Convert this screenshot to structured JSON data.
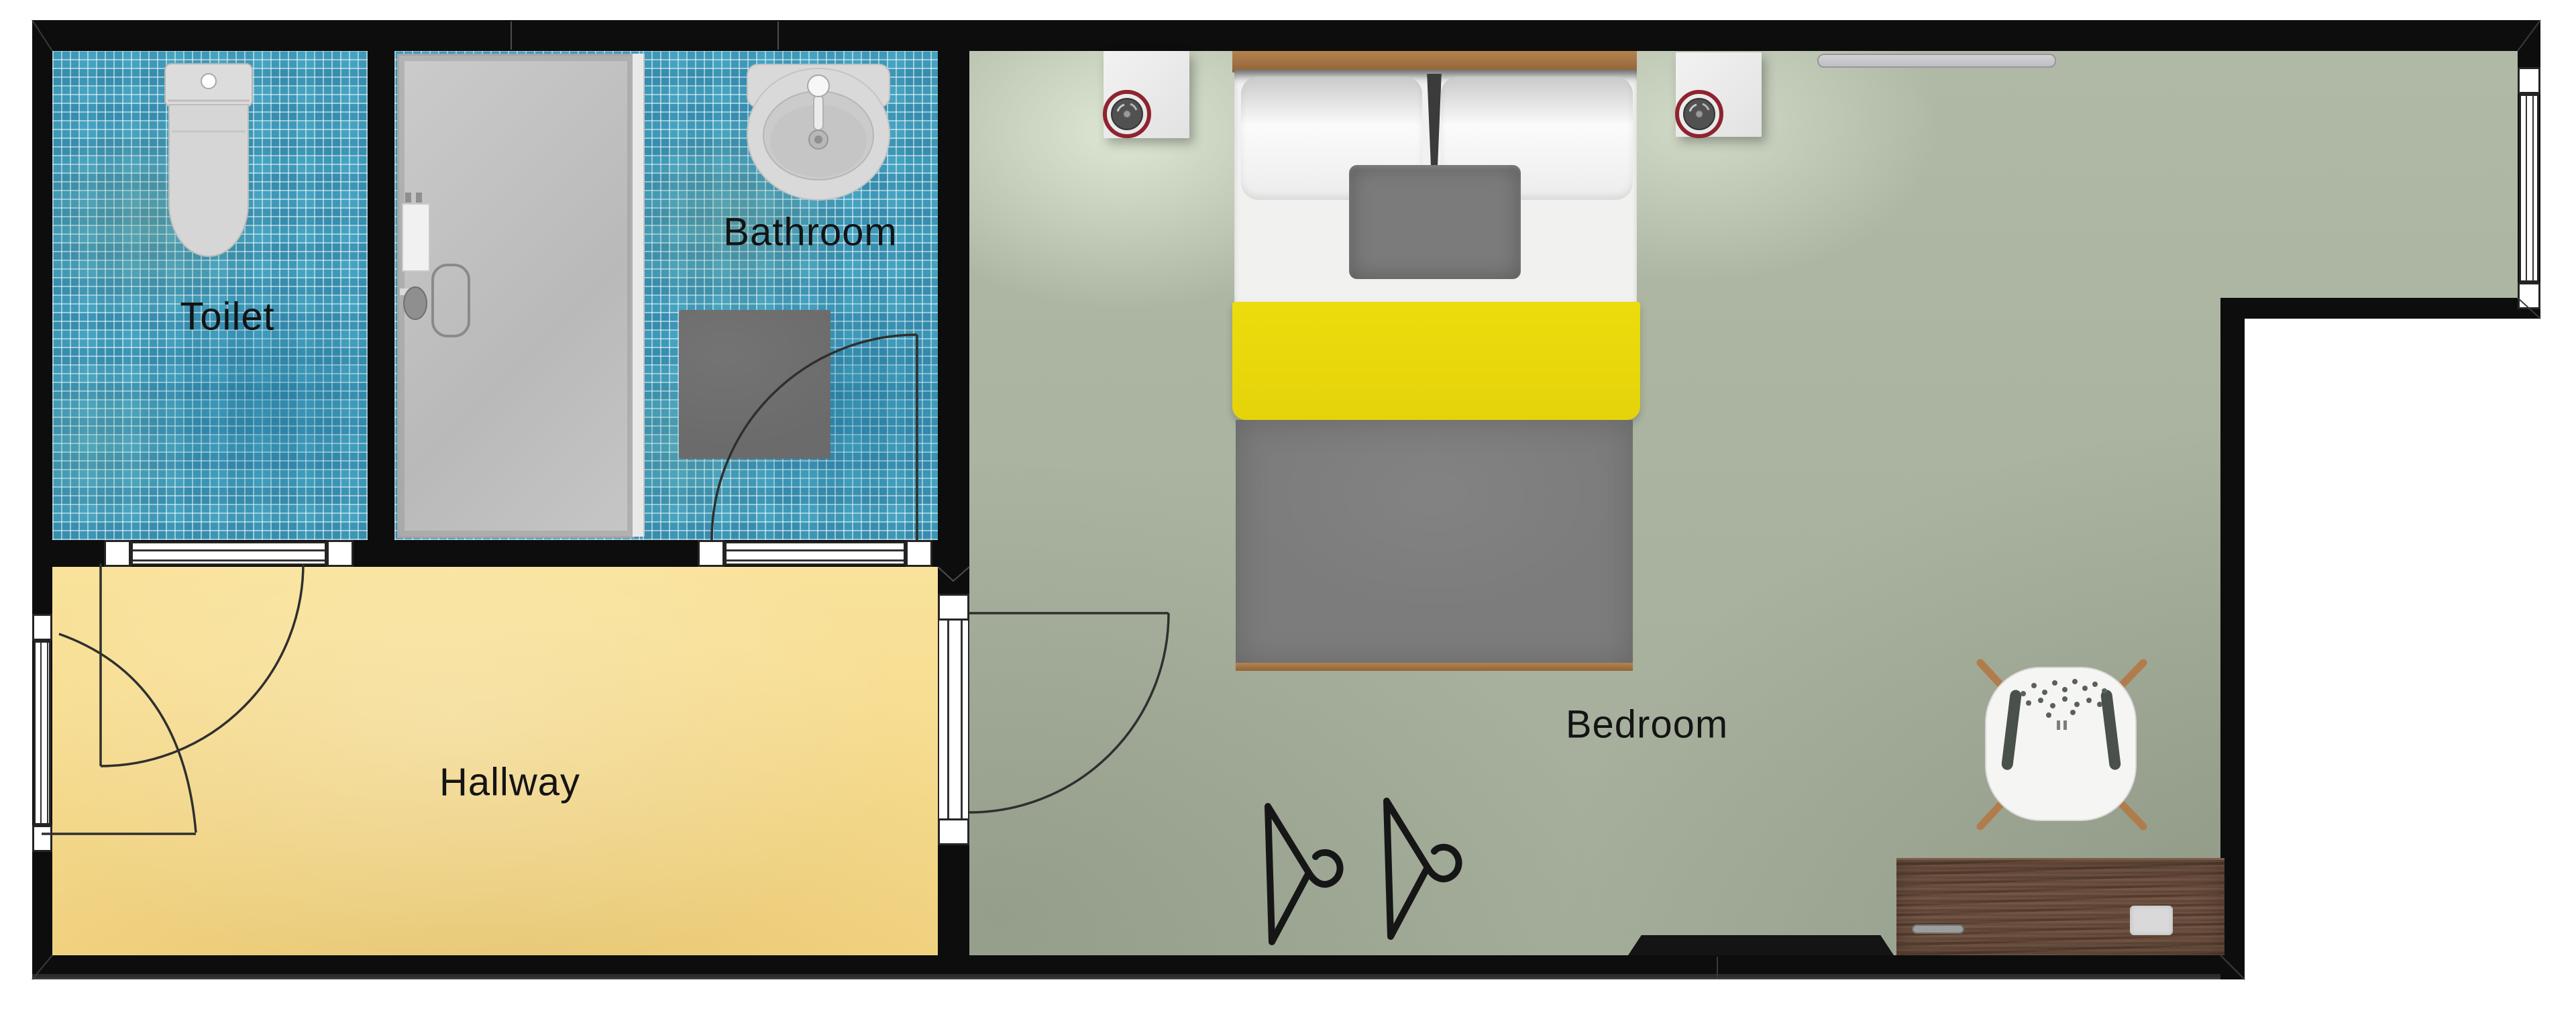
{
  "plan": {
    "type": "apartment floor plan (top-down render)",
    "rooms": [
      {
        "id": "toilet",
        "label": "Toilet"
      },
      {
        "id": "bathroom",
        "label": "Bathroom"
      },
      {
        "id": "hallway",
        "label": "Hallway"
      },
      {
        "id": "bedroom",
        "label": "Bedroom"
      }
    ],
    "fixtures": [
      "toilet",
      "wash-basin",
      "shower-enclosure",
      "bath-mat",
      "double-bed",
      "pillows",
      "accent-pillow",
      "nightstand-left",
      "nightstand-right",
      "lamp-left",
      "lamp-right",
      "wall-shelf",
      "desk",
      "desk-chair",
      "tv-unit",
      "clothes-hanger-1",
      "clothes-hanger-2",
      "door-toilet",
      "door-entry",
      "door-bathroom",
      "door-bedroom",
      "window-left",
      "window-right",
      "window-toilet",
      "window-bathroom"
    ],
    "colors": {
      "wall": "#0d0d0d",
      "tile_floor": "#45a3c1",
      "hallway_floor": "#f8df93",
      "bedroom_floor": "#a9b3a0",
      "shower_tray": "#c2c2c2",
      "bed_yellow": "#e9d70e",
      "bed_gray": "#7c7c7c",
      "wood_light": "#ab7d50",
      "desk_wood": "#5d4334",
      "lamp_ring": "#8e2430"
    }
  }
}
